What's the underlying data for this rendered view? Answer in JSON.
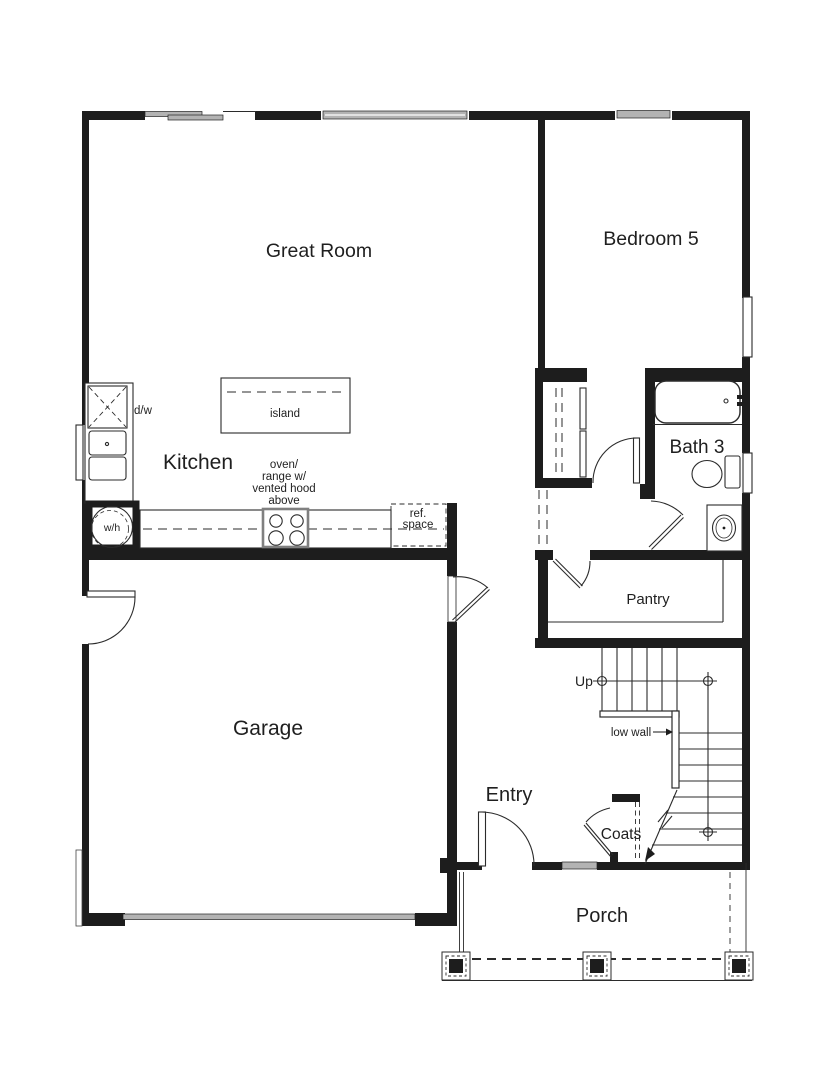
{
  "colors": {
    "wall": "#1d1d1d",
    "line": "#2b2b2b",
    "window_fill": "#b3b3b3",
    "text": "#1f1f1f",
    "bg": "#ffffff"
  },
  "rooms": {
    "great_room": "Great Room",
    "bedroom5": "Bedroom 5",
    "kitchen": "Kitchen",
    "bath3": "Bath 3",
    "pantry": "Pantry",
    "garage": "Garage",
    "entry": "Entry",
    "coats": "Coats",
    "porch": "Porch"
  },
  "annotations": {
    "island": "island",
    "dishwasher": "d/w",
    "water_heater": "w/h",
    "range_note_lines": [
      "oven/",
      "range w/",
      "vented hood",
      "above"
    ],
    "ref_note_lines": [
      "ref.",
      "space"
    ],
    "stairs_up": "Up",
    "low_wall": "low wall"
  }
}
